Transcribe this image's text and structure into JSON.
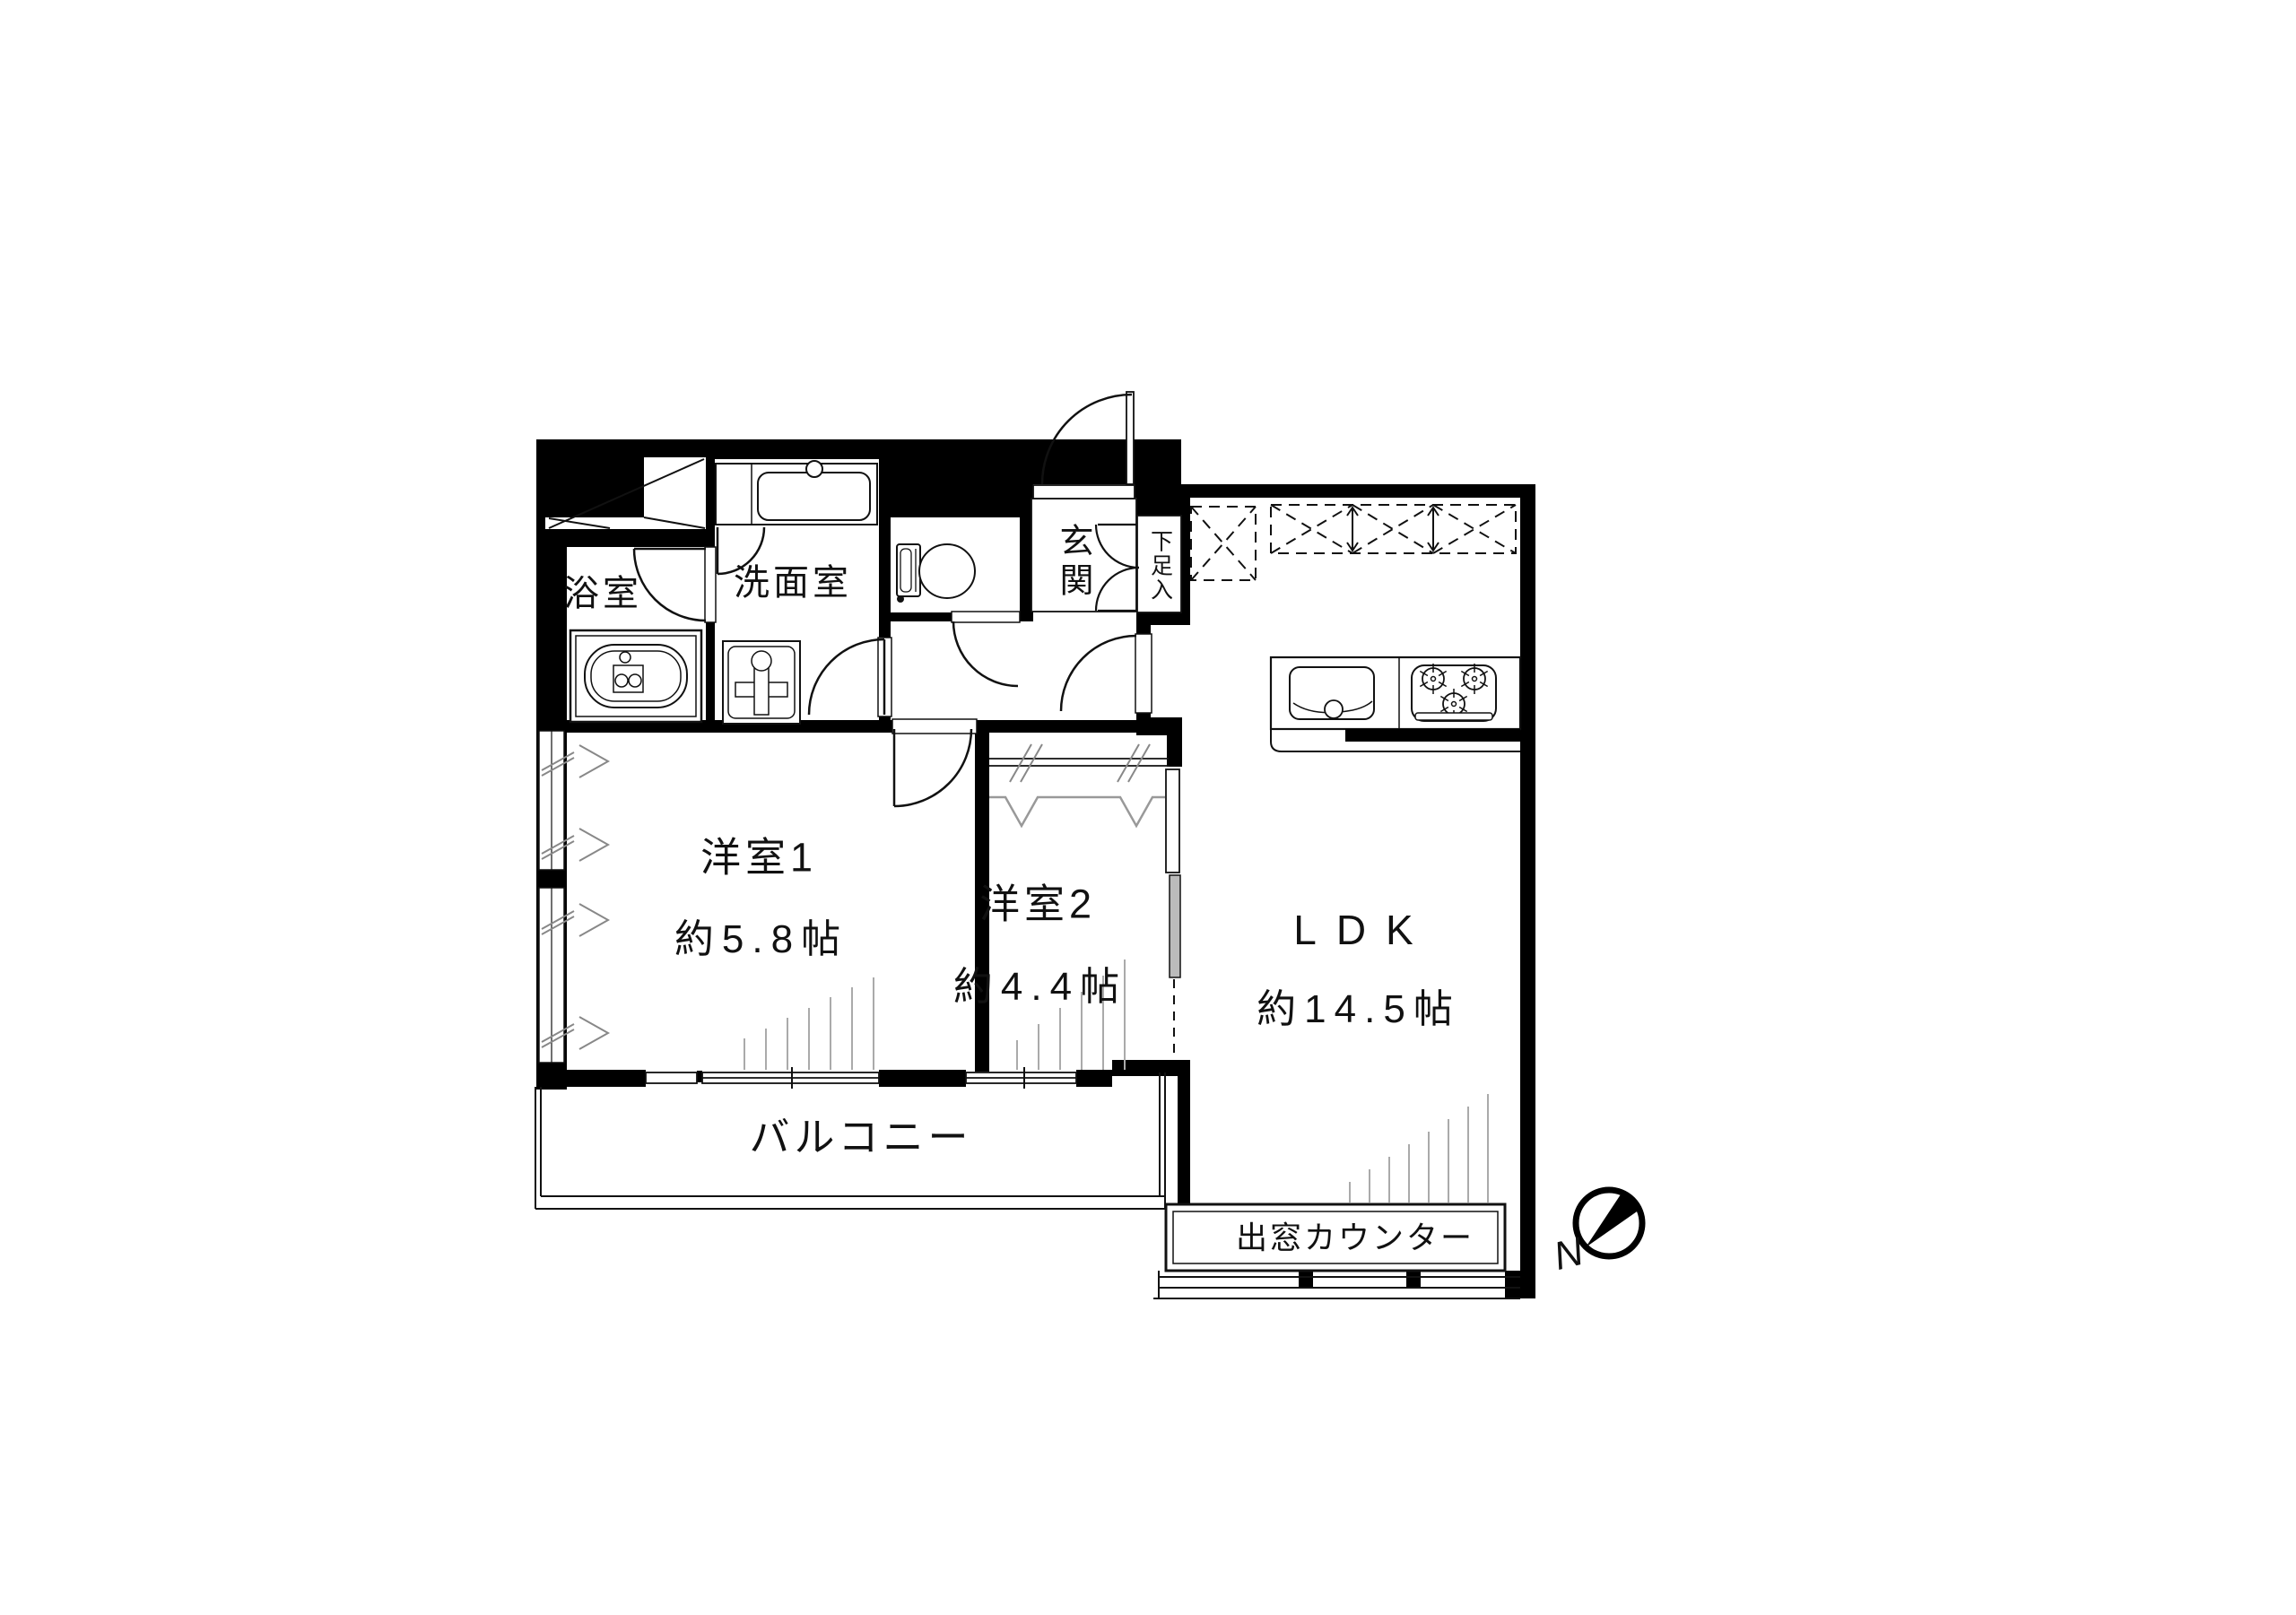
{
  "diagram": {
    "type": "apartment-floor-plan",
    "colors": {
      "wall": "#000000",
      "background": "#ffffff",
      "hatch": "#aaaaaa",
      "line": "#111111"
    },
    "rooms": {
      "bathroom": {
        "label": "浴室"
      },
      "washroom": {
        "label": "洗面室"
      },
      "entrance": {
        "label": "玄関"
      },
      "shoe_cabinet": {
        "label": "下足入"
      },
      "bedroom1": {
        "label": "洋室1",
        "area": "約5.8帖"
      },
      "bedroom2": {
        "label": "洋室2",
        "area": "約4.4帖"
      },
      "ldk": {
        "label": "LDK",
        "area": "約14.5帖"
      },
      "balcony": {
        "label": "バルコニー"
      },
      "bay_window": {
        "label": "出窓カウンター"
      }
    },
    "compass": {
      "label": "N"
    },
    "fixtures": [
      "bathtub",
      "vanity-sink",
      "washing-machine-pan",
      "toilet",
      "kitchen-sink",
      "gas-stove",
      "hanging-cupboards",
      "bay-window-counter"
    ]
  }
}
